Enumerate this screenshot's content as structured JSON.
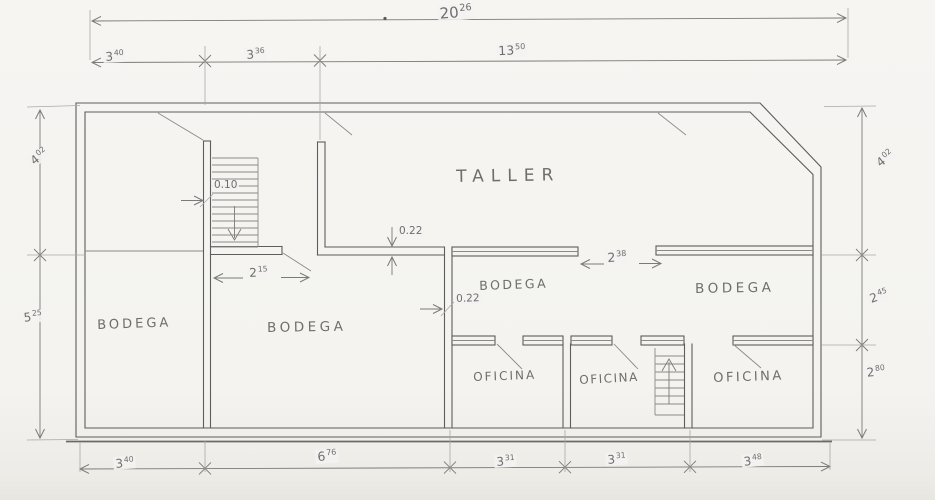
{
  "document": {
    "type": "hand-drawn architectural floor plan sketch"
  },
  "colors": {
    "paper": "#f4f3f0",
    "ink": "#6e6e6e",
    "wall": "#5d5d5d"
  },
  "rooms": {
    "taller": "TALLER",
    "bodega_left": "BODEGA",
    "bodega_center": "BODEGA",
    "bodega_middle": "BODEGA",
    "bodega_right": "BODEGA",
    "oficina_1": "OFICINA",
    "oficina_2": "OFICINA",
    "oficina_3": "OFICINA"
  },
  "dimensions": {
    "top_total": {
      "main": "20",
      "sup": "26"
    },
    "top_row": [
      {
        "main": "3",
        "sup": "40"
      },
      {
        "main": "3",
        "sup": "36"
      },
      {
        "main": "13",
        "sup": "50"
      }
    ],
    "left_col": [
      {
        "main": "4",
        "sup": "02"
      },
      {
        "main": "5",
        "sup": "25"
      }
    ],
    "right_col": [
      {
        "main": "4",
        "sup": "02"
      },
      {
        "main": "2",
        "sup": "45"
      },
      {
        "main": "2",
        "sup": "80"
      }
    ],
    "bottom_row": [
      {
        "main": "3",
        "sup": "40"
      },
      {
        "main": "6",
        "sup": "76"
      },
      {
        "main": "3",
        "sup": "31"
      },
      {
        "main": "3",
        "sup": "31"
      },
      {
        "main": "3",
        "sup": "48"
      }
    ],
    "interior": {
      "stair_tread": "0.10",
      "bodega_opening": {
        "main": "2",
        "sup": "15"
      },
      "wall_thickness_taller": "0.22",
      "wall_thickness_mid": "0.22",
      "corridor_opening": {
        "main": "2",
        "sup": "38"
      }
    }
  }
}
